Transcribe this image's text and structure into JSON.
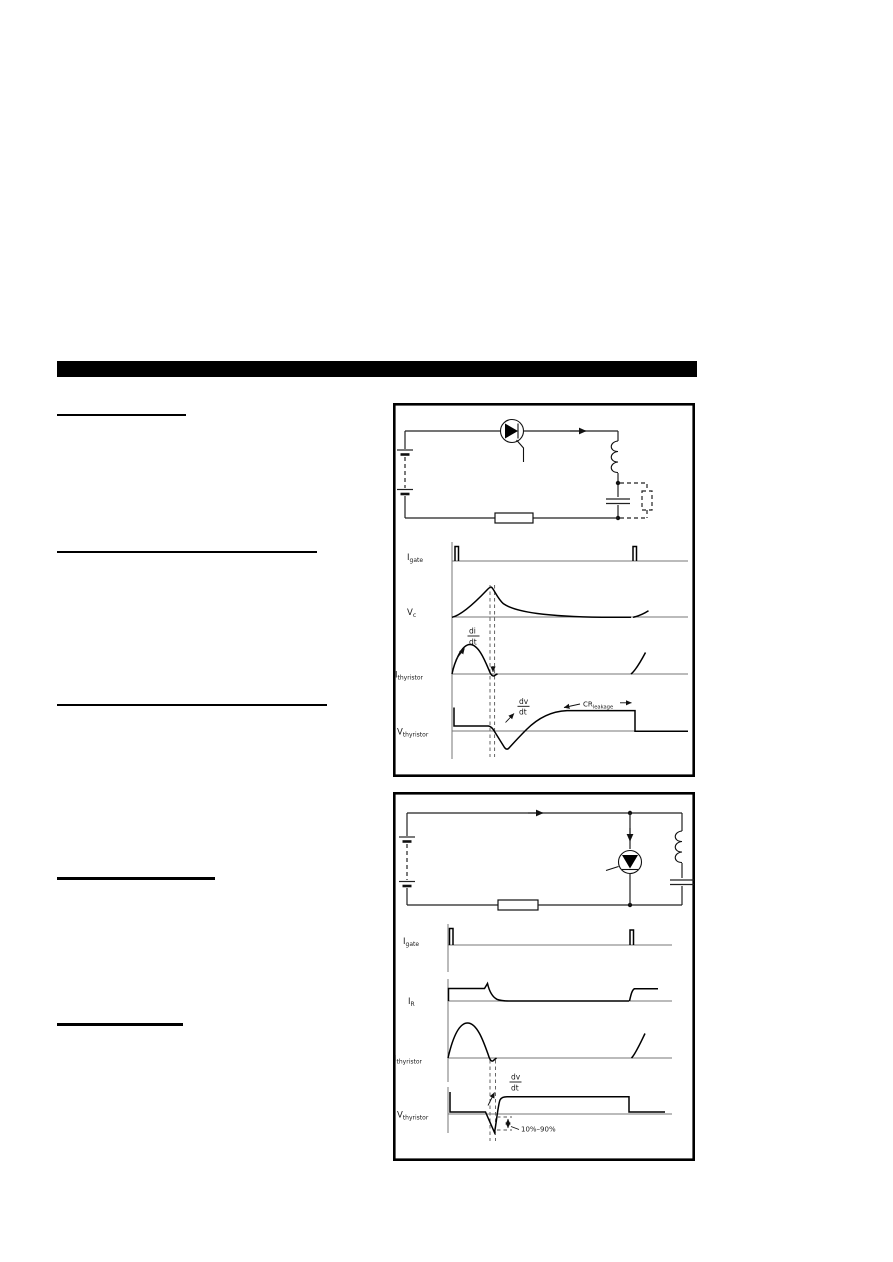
{
  "page": {
    "background": "#ffffff",
    "title_bar_color": "#000000",
    "ink_color": "#111111"
  },
  "figure_top": {
    "waveform_labels": [
      {
        "main": "I",
        "sub": "gate"
      },
      {
        "main": "V",
        "sub": "c"
      },
      {
        "main": "I",
        "sub": "thyristor"
      },
      {
        "main": "V",
        "sub": "thyristor"
      }
    ],
    "annotations": {
      "di_dt": {
        "num": "di",
        "den": "dt"
      },
      "dv_dt": {
        "num": "dv",
        "den": "dt"
      },
      "cr_leakage": {
        "main": "CR",
        "sub": "leakage"
      }
    }
  },
  "figure_bottom": {
    "waveform_labels": [
      {
        "main": "I",
        "sub": "gate"
      },
      {
        "main": "I",
        "sub": "R"
      },
      {
        "main": "I",
        "sub": "thyristor"
      },
      {
        "main": "V",
        "sub": "thyristor"
      }
    ],
    "annotations": {
      "dv_dt": {
        "num": "dv",
        "den": "dt"
      },
      "rise_range": "10%–90%"
    }
  }
}
